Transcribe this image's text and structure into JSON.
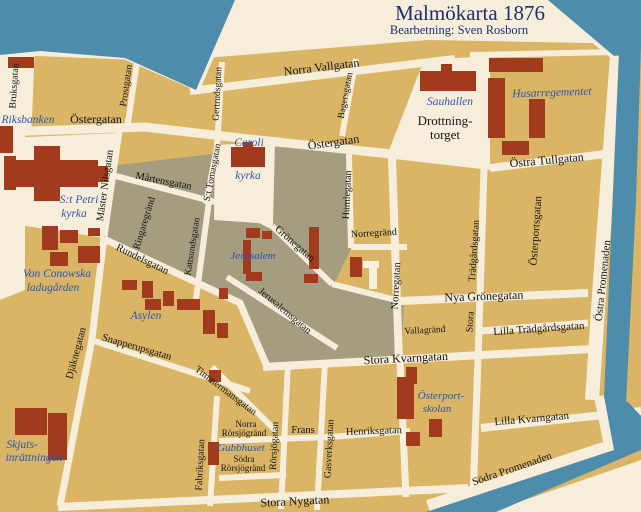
{
  "title": {
    "main": "Malmökarta 1876",
    "subtitle": "Bearbetning: Sven Rosborn"
  },
  "colors": {
    "water": "#4e8cab",
    "land_background": "#f6eeda",
    "block_tan": "#d9b565",
    "block_gray": "#a49d80",
    "building_red": "#a23b1e",
    "street_text": "#151515",
    "place_text": "#2a57a5",
    "title_text": "#1c2e6e"
  },
  "map": {
    "labels": [
      {
        "id": "title",
        "text": "Malmökarta 1876",
        "x": 470,
        "y": 20,
        "rot": 0,
        "size": 21,
        "kind": "title"
      },
      {
        "id": "subtitle",
        "text": "Bearbetning: Sven Rosborn",
        "x": 459,
        "y": 34,
        "rot": 0,
        "size": 12.5,
        "kind": "subtitle"
      },
      {
        "id": "norra-vallgatan",
        "text": "Norra Vallgatan",
        "x": 322,
        "y": 71,
        "rot": -7,
        "size": 12,
        "kind": "street"
      },
      {
        "id": "bruksgatan",
        "text": "Bruksgatan",
        "x": 17,
        "y": 86,
        "rot": -86,
        "size": 10,
        "kind": "street"
      },
      {
        "id": "ostergatan-w",
        "text": "Östergatan",
        "x": 96,
        "y": 123,
        "rot": 0,
        "size": 12,
        "kind": "street"
      },
      {
        "id": "prostgatan",
        "text": "Prostgatan",
        "x": 129,
        "y": 86,
        "rot": -82,
        "size": 10,
        "kind": "street"
      },
      {
        "id": "gertrudsgatan",
        "text": "Gertrudsgatan",
        "x": 220,
        "y": 94,
        "rot": -87,
        "size": 9.5,
        "kind": "street"
      },
      {
        "id": "bagersgatan",
        "text": "Bagersgatan",
        "x": 348,
        "y": 96,
        "rot": -79,
        "size": 9.5,
        "kind": "street"
      },
      {
        "id": "ostergatan-e",
        "text": "Östergatan",
        "x": 334,
        "y": 146,
        "rot": -8,
        "size": 12,
        "kind": "street"
      },
      {
        "id": "drottning-1",
        "text": "Drottning-",
        "x": 445,
        "y": 125,
        "rot": 0,
        "size": 13,
        "kind": "square"
      },
      {
        "id": "drottning-2",
        "text": "torget",
        "x": 445,
        "y": 139,
        "rot": 0,
        "size": 13,
        "kind": "square"
      },
      {
        "id": "ostra-tullgatan",
        "text": "Östra Tullgatan",
        "x": 547,
        "y": 164,
        "rot": -5,
        "size": 12,
        "kind": "street"
      },
      {
        "id": "master-nilsgatan",
        "text": "Mäster Nilsgatan",
        "x": 108,
        "y": 186,
        "rot": -82,
        "size": 10.5,
        "kind": "street"
      },
      {
        "id": "martensgatan",
        "text": "Mårtensgatan",
        "x": 163,
        "y": 184,
        "rot": 11,
        "size": 10.5,
        "kind": "street"
      },
      {
        "id": "st-tomasgatan",
        "text": "S:t Tomasgatan",
        "x": 215,
        "y": 173,
        "rot": -79,
        "size": 9.5,
        "kind": "street"
      },
      {
        "id": "kattsundsgatan",
        "text": "Kattsundsgatan",
        "x": 195,
        "y": 247,
        "rot": -81,
        "size": 9.5,
        "kind": "street"
      },
      {
        "id": "ringaregrand",
        "text": "Ringaregränd",
        "x": 147,
        "y": 224,
        "rot": -73,
        "size": 10,
        "kind": "street"
      },
      {
        "id": "rundelsgatan",
        "text": "Rundelsgatan",
        "x": 141,
        "y": 262,
        "rot": 26,
        "size": 10.5,
        "kind": "street"
      },
      {
        "id": "gronegatan",
        "text": "Grönegatan",
        "x": 293,
        "y": 246,
        "rot": 41,
        "size": 10.5,
        "kind": "street"
      },
      {
        "id": "jerusalemsgatan",
        "text": "Jerusalemsgatan",
        "x": 283,
        "y": 313,
        "rot": 40,
        "size": 10,
        "kind": "street"
      },
      {
        "id": "humlegatan",
        "text": "Humlegatan",
        "x": 350,
        "y": 195,
        "rot": -87,
        "size": 10,
        "kind": "street"
      },
      {
        "id": "norregrand",
        "text": "Norregränd",
        "x": 374,
        "y": 236,
        "rot": -3,
        "size": 10,
        "kind": "street"
      },
      {
        "id": "norregatan",
        "text": "Norregatan",
        "x": 399,
        "y": 286,
        "rot": -87,
        "size": 10.5,
        "kind": "street"
      },
      {
        "id": "nya-gronegatan",
        "text": "Nya Grönegatan",
        "x": 484,
        "y": 300,
        "rot": -2,
        "size": 12,
        "kind": "street"
      },
      {
        "id": "tradgardsgatan",
        "text": "Trädgårdsgatan",
        "x": 477,
        "y": 251,
        "rot": -86,
        "size": 10,
        "kind": "street"
      },
      {
        "id": "stora-t",
        "text": "Stora",
        "x": 473,
        "y": 322,
        "rot": -86,
        "size": 10,
        "kind": "street"
      },
      {
        "id": "osterportsgatan",
        "text": "Österportsgatan",
        "x": 539,
        "y": 231,
        "rot": -86,
        "size": 11,
        "kind": "street"
      },
      {
        "id": "ostra-promenaden",
        "text": "Östra Promenaden",
        "x": 606,
        "y": 281,
        "rot": -84,
        "size": 11,
        "kind": "street"
      },
      {
        "id": "lilla-tradgardsgatan",
        "text": "Lilla Trädgårdsgatan",
        "x": 539,
        "y": 332,
        "rot": -4,
        "size": 11,
        "kind": "street"
      },
      {
        "id": "vallagrand",
        "text": "Vallagränd",
        "x": 425,
        "y": 333,
        "rot": -3,
        "size": 9.5,
        "kind": "street"
      },
      {
        "id": "stora-kvarngatan",
        "text": "Stora Kvarngatan",
        "x": 406,
        "y": 362,
        "rot": -3,
        "size": 12,
        "kind": "street"
      },
      {
        "id": "snapperupsgatan",
        "text": "Snapperupsgatan",
        "x": 136,
        "y": 350,
        "rot": 16,
        "size": 10.5,
        "kind": "street"
      },
      {
        "id": "djaknegatan",
        "text": "Djäknegatan",
        "x": 79,
        "y": 354,
        "rot": -75,
        "size": 10.5,
        "kind": "street"
      },
      {
        "id": "timmermansgatan",
        "text": "Timmermansgatan",
        "x": 224,
        "y": 393,
        "rot": 37,
        "size": 10,
        "kind": "street"
      },
      {
        "id": "norra-r-1",
        "text": "Norra",
        "x": 246,
        "y": 427,
        "rot": 0,
        "size": 9,
        "kind": "street"
      },
      {
        "id": "norra-r-2",
        "text": "Rörsjögränd",
        "x": 244,
        "y": 436,
        "rot": 0,
        "size": 9,
        "kind": "street"
      },
      {
        "id": "sodra-r-1",
        "text": "Södra",
        "x": 244,
        "y": 462,
        "rot": 0,
        "size": 9,
        "kind": "street"
      },
      {
        "id": "sodra-r-2",
        "text": "Rörsjögränd",
        "x": 243,
        "y": 471,
        "rot": 0,
        "size": 9,
        "kind": "street"
      },
      {
        "id": "fabriksgatan",
        "text": "Fabriksgatan",
        "x": 203,
        "y": 465,
        "rot": -87,
        "size": 10,
        "kind": "street"
      },
      {
        "id": "rorsjogatan",
        "text": "Rörsjögatan",
        "x": 277,
        "y": 446,
        "rot": -87,
        "size": 10,
        "kind": "street"
      },
      {
        "id": "frans",
        "text": "Frans",
        "x": 303,
        "y": 433,
        "rot": 0,
        "size": 10.5,
        "kind": "street"
      },
      {
        "id": "gasverksgatan",
        "text": "Gasverksgatan",
        "x": 332,
        "y": 449,
        "rot": -87,
        "size": 10,
        "kind": "street"
      },
      {
        "id": "henriksgatan",
        "text": "Henriksgatan",
        "x": 374,
        "y": 434,
        "rot": -2,
        "size": 10.5,
        "kind": "street"
      },
      {
        "id": "lilla-kvarngatan",
        "text": "Lilla Kvarngatan",
        "x": 532,
        "y": 422,
        "rot": -5,
        "size": 11,
        "kind": "street"
      },
      {
        "id": "sodra-promenaden",
        "text": "Södra Promenaden",
        "x": 513,
        "y": 472,
        "rot": -19,
        "size": 11,
        "kind": "street"
      },
      {
        "id": "stora-nygatan",
        "text": "Stora Nygatan",
        "x": 295,
        "y": 505,
        "rot": -3,
        "size": 12,
        "kind": "street"
      },
      {
        "id": "riksbanken",
        "text": "Riksbanken",
        "x": 28,
        "y": 123,
        "rot": 0,
        "size": 11.5,
        "kind": "place"
      },
      {
        "id": "petri-1",
        "text": "S:t Petri",
        "x": 79,
        "y": 203,
        "rot": 0,
        "size": 11.5,
        "kind": "place"
      },
      {
        "id": "petri-2",
        "text": "kyrka",
        "x": 74,
        "y": 217,
        "rot": 0,
        "size": 11.5,
        "kind": "place"
      },
      {
        "id": "caroli-1",
        "text": "Caroli",
        "x": 249,
        "y": 146,
        "rot": 0,
        "size": 11.5,
        "kind": "place"
      },
      {
        "id": "caroli-2",
        "text": "kyrka",
        "x": 248,
        "y": 179,
        "rot": 0,
        "size": 11.5,
        "kind": "place"
      },
      {
        "id": "sauhallen",
        "text": "Sauhallen",
        "x": 450,
        "y": 105,
        "rot": 0,
        "size": 11.5,
        "kind": "place"
      },
      {
        "id": "husarregementet",
        "text": "Husarregementet",
        "x": 552,
        "y": 96,
        "rot": -2,
        "size": 11.5,
        "kind": "place"
      },
      {
        "id": "conowska-1",
        "text": "Von Conowska",
        "x": 57,
        "y": 277,
        "rot": 0,
        "size": 11.5,
        "kind": "place"
      },
      {
        "id": "conowska-2",
        "text": "ladugården",
        "x": 53,
        "y": 291,
        "rot": 0,
        "size": 11.5,
        "kind": "place"
      },
      {
        "id": "jerusalem",
        "text": "Jerusalem",
        "x": 253,
        "y": 259,
        "rot": 0,
        "size": 11,
        "kind": "place"
      },
      {
        "id": "asylen",
        "text": "Asylen",
        "x": 146,
        "y": 319,
        "rot": 0,
        "size": 11.5,
        "kind": "place"
      },
      {
        "id": "osterport-1",
        "text": "Österport-",
        "x": 441,
        "y": 399,
        "rot": 0,
        "size": 11,
        "kind": "place"
      },
      {
        "id": "osterport-2",
        "text": "skolan",
        "x": 437,
        "y": 412,
        "rot": 0,
        "size": 11,
        "kind": "place"
      },
      {
        "id": "gubbhuset",
        "text": "Gubbhuset",
        "x": 241,
        "y": 451,
        "rot": 0,
        "size": 11,
        "kind": "place"
      },
      {
        "id": "skjuts-1",
        "text": "Skjuts-",
        "x": 22,
        "y": 448,
        "rot": 0,
        "size": 11.5,
        "kind": "place"
      },
      {
        "id": "skjuts-2",
        "text": "inrättningen",
        "x": 34,
        "y": 461,
        "rot": 0,
        "size": 11.5,
        "kind": "place"
      }
    ]
  }
}
